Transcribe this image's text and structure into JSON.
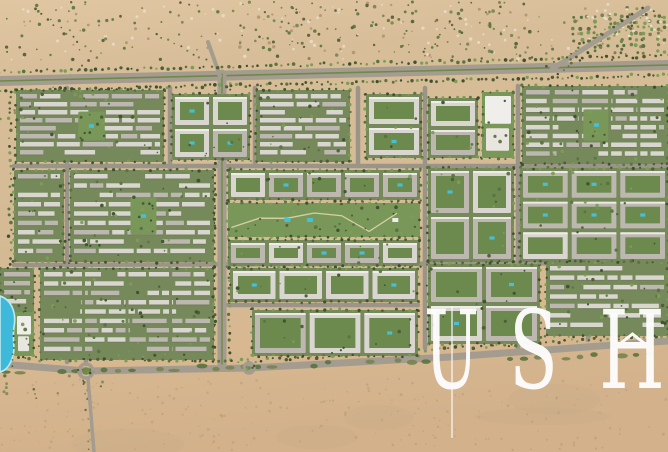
{
  "watermark": {
    "text": "USH",
    "letters": [
      "U",
      "S",
      "H"
    ],
    "color": "#fdfdfc",
    "style": "serif-wordmark-with-roof-chevron"
  },
  "scene": {
    "width": 668,
    "height": 452,
    "colors": {
      "sand_top": "#decmmm",
      "sand_stops": [
        "#e0c7a2",
        "#d7bd98",
        "#d4bb95",
        "#d7b891",
        "#d2b18b"
      ],
      "speck_dark": "#b2946f",
      "shrub_dark": "#4f5c36",
      "shrub_olive": "#77834f",
      "tree_dark": "#3c512d",
      "tree_mid": "#5a7340",
      "tree_light": "#7d9c55",
      "road_asphalt": "#a49c8f",
      "street_gray": "#9b9488",
      "median_green": "#6d8a4a",
      "block_green": "#75895a",
      "park_green": "#7a975a",
      "path_sand": "#d6cfa6",
      "roof_light": "#d9d6cf",
      "roof_mid": "#bcb8b0",
      "roof_white": "#efeeea",
      "roof_shadow": "#6f6b62",
      "courtyard_green": "#6c8a4e",
      "pool_cyan": "#45c0d8",
      "lagoon_blue": "#3fb9da",
      "lagoon_rim": "#bfe9f2",
      "tent_white": "#ece3d1",
      "track_tan": "#b7a282"
    },
    "main_road": {
      "pts": [
        [
          0,
          81
        ],
        [
          668,
          65
        ]
      ],
      "width": 10
    },
    "avenue": {
      "pts": [
        [
          222,
          74
        ],
        [
          222,
          364
        ]
      ],
      "width": 9
    },
    "bottom_road": {
      "pts": [
        [
          0,
          364
        ],
        [
          86,
          371
        ],
        [
          249,
          368
        ],
        [
          450,
          357
        ],
        [
          668,
          341
        ]
      ],
      "width": 7
    },
    "streets": [
      [
        14,
        166,
        668,
        166
      ],
      [
        14,
        265,
        668,
        263
      ],
      [
        67,
        88,
        67,
        362
      ],
      [
        170,
        88,
        170,
        266
      ],
      [
        255,
        88,
        255,
        166
      ],
      [
        358,
        88,
        358,
        166
      ],
      [
        425,
        88,
        425,
        348
      ],
      [
        518,
        86,
        518,
        348
      ],
      [
        86,
        266,
        86,
        364
      ],
      [
        588,
        262,
        588,
        340
      ],
      [
        228,
        305,
        418,
        305
      ]
    ],
    "diagonals": [
      {
        "pts": [
          [
            552,
            69
          ],
          [
            648,
            8
          ]
        ],
        "width": 5
      },
      {
        "pts": [
          [
            220,
            76
          ],
          [
            208,
            42
          ]
        ],
        "width": 4
      },
      {
        "pts": [
          [
            88,
            378
          ],
          [
            94,
            452
          ]
        ],
        "width": 3.5
      }
    ],
    "roundabouts": [
      {
        "x": 86,
        "y": 371,
        "r": 7
      },
      {
        "x": 249,
        "y": 368,
        "r": 5
      }
    ],
    "speckles": {
      "top": {
        "x": 0,
        "y": 2,
        "w": 668,
        "h": 58,
        "n": 520,
        "dense_x1": 238,
        "dense_x2": 532,
        "sparse_p": 0.4
      },
      "bottom": {
        "x": 0,
        "y": 378,
        "w": 668,
        "h": 72,
        "n": 230
      }
    },
    "tracks": [
      [
        2,
        118,
        96,
        58
      ],
      [
        36,
        10,
        90,
        52
      ],
      [
        150,
        30,
        206,
        60
      ]
    ],
    "orchard": {
      "x": 574,
      "y": 16,
      "w": 92,
      "h": 42,
      "step": 7
    },
    "tents": {
      "x": 586,
      "y": 3,
      "w": 78,
      "h": 40,
      "n": 26
    },
    "verges": [
      {
        "pts": [
          [
            0,
            72
          ],
          [
            668,
            56
          ]
        ],
        "step": 6
      },
      {
        "pts": [
          [
            0,
            91
          ],
          [
            668,
            75
          ]
        ],
        "step": 5
      },
      {
        "pts": [
          [
            10,
            96
          ],
          [
            10,
            264
          ]
        ],
        "step": 7
      },
      {
        "pts": [
          [
            0,
            357
          ],
          [
            249,
            361
          ]
        ],
        "step": 6
      },
      {
        "pts": [
          [
            249,
            361
          ],
          [
            668,
            335
          ]
        ],
        "step": 6
      }
    ],
    "lagoon": {
      "path": "M0,296 C10,299 17,311 14,327 C12,339 16,349 12,359 C8,369 4,371 0,372 Z"
    },
    "blocks": [
      {
        "x": 16,
        "y": 90,
        "w": 148,
        "h": 72,
        "t": "rows",
        "n": 8,
        "park": 1
      },
      {
        "x": 172,
        "y": 94,
        "w": 78,
        "h": 66,
        "t": "court",
        "c": 2,
        "r": 2
      },
      {
        "x": 256,
        "y": 90,
        "w": 94,
        "h": 72,
        "t": "rows",
        "n": 8
      },
      {
        "x": 366,
        "y": 94,
        "w": 56,
        "h": 64,
        "t": "court",
        "c": 1,
        "r": 2
      },
      {
        "x": 428,
        "y": 98,
        "w": 50,
        "h": 60,
        "t": "court",
        "c": 1,
        "r": 2
      },
      {
        "x": 482,
        "y": 92,
        "w": 32,
        "h": 66,
        "t": "civic"
      },
      {
        "x": 522,
        "y": 86,
        "w": 146,
        "h": 78,
        "t": "grid",
        "n": 8,
        "c": 5,
        "park": 1
      },
      {
        "x": 14,
        "y": 170,
        "w": 50,
        "h": 92,
        "t": "rows",
        "n": 9
      },
      {
        "x": 70,
        "y": 170,
        "w": 144,
        "h": 92,
        "t": "rows",
        "n": 9,
        "park": 1
      },
      {
        "x": 228,
        "y": 170,
        "w": 192,
        "h": 30,
        "t": "court",
        "c": 5,
        "r": 1
      },
      {
        "x": 228,
        "y": 203,
        "w": 192,
        "h": 34,
        "t": "park"
      },
      {
        "x": 228,
        "y": 240,
        "w": 192,
        "h": 26,
        "t": "court",
        "c": 5,
        "r": 1
      },
      {
        "x": 428,
        "y": 168,
        "w": 86,
        "h": 94,
        "t": "court",
        "c": 2,
        "r": 2
      },
      {
        "x": 520,
        "y": 168,
        "w": 148,
        "h": 94,
        "t": "court",
        "c": 3,
        "r": 3
      },
      {
        "x": 0,
        "y": 268,
        "w": 34,
        "h": 44,
        "t": "rows",
        "n": 4
      },
      {
        "x": 40,
        "y": 268,
        "w": 174,
        "h": 92,
        "t": "grid",
        "n": 9,
        "c": 4
      },
      {
        "x": 230,
        "y": 268,
        "w": 188,
        "h": 34,
        "t": "court",
        "c": 4,
        "r": 1
      },
      {
        "x": 252,
        "y": 310,
        "w": 166,
        "h": 46,
        "t": "court",
        "c": 3,
        "r": 1
      },
      {
        "x": 428,
        "y": 264,
        "w": 112,
        "h": 80,
        "t": "court",
        "c": 2,
        "r": 2
      },
      {
        "x": 546,
        "y": 262,
        "w": 122,
        "h": 74,
        "t": "rows",
        "n": 7
      },
      {
        "x": 14,
        "y": 312,
        "w": 20,
        "h": 44,
        "t": "civic"
      }
    ]
  }
}
